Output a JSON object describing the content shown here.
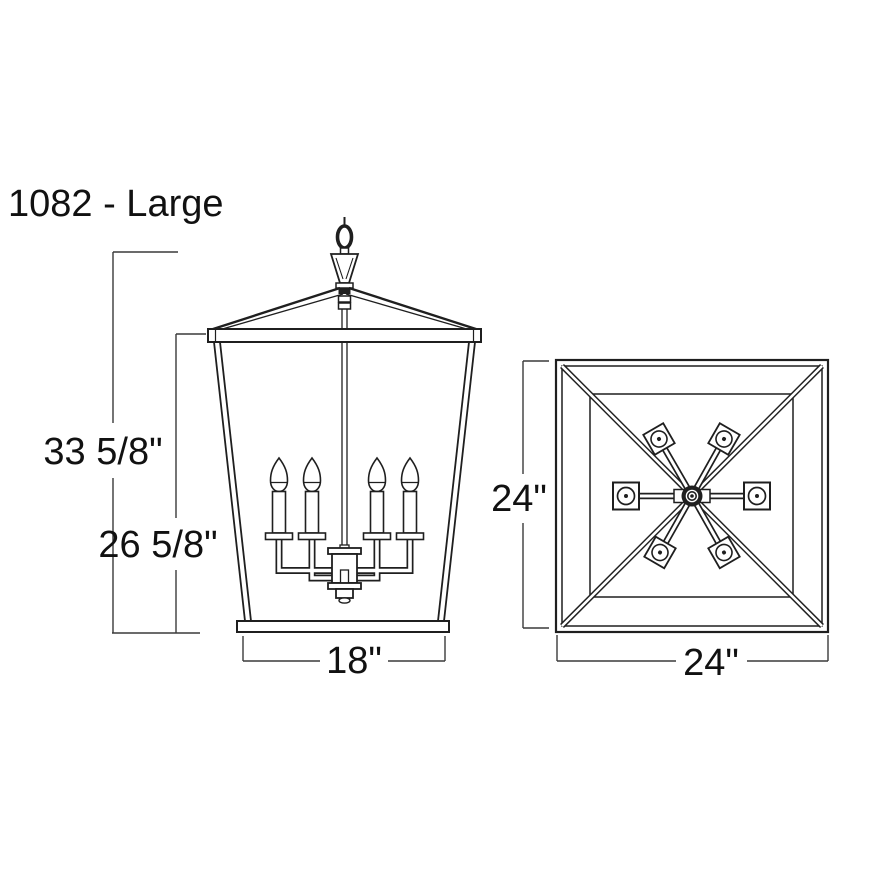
{
  "title": "1082 - Large",
  "drawing": {
    "type": "technical-dimension-diagram",
    "line_color": "#1f1f1f",
    "background": "#ffffff"
  },
  "front_view": {
    "label": "front-elevation",
    "dims": {
      "height_overall": "33 5/8\"",
      "height_cage": "26 5/8\"",
      "width_bottom": "18\""
    }
  },
  "top_view": {
    "label": "top-plan",
    "dims": {
      "depth": "24\"",
      "width": "24\""
    }
  }
}
